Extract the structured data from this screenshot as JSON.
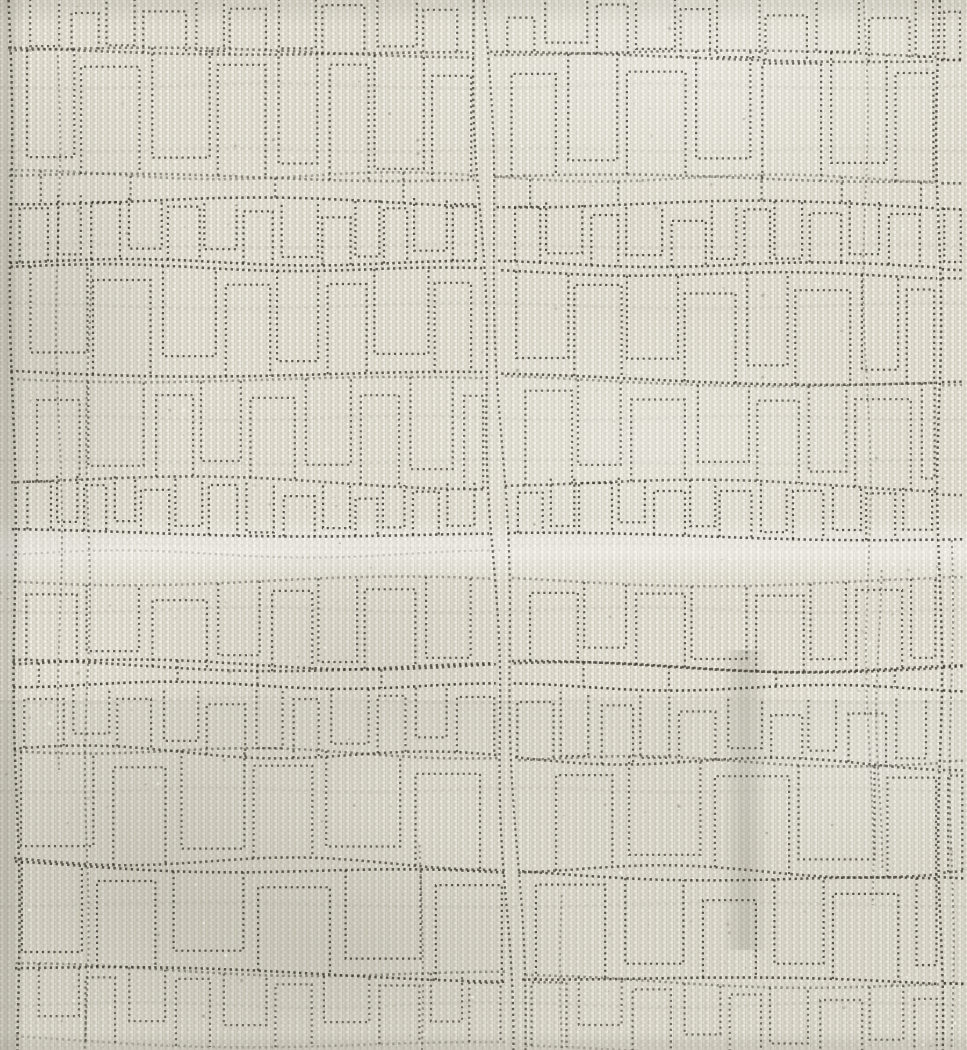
{
  "scene": {
    "description": "Close-up photograph of handwoven off-white linen fabric embroidered with dark running-stitch thread forming horizontal bands of interlocking rectangular meander (battlement) motifs, crossed by vertical stitched seam lines and soft fold shadows",
    "type": "fabric-textile-photo"
  },
  "canvas": {
    "width": 967,
    "height": 1050
  },
  "seed": 13,
  "palette": {
    "fabric_base": "#e6e3d8",
    "weave_gap": "#ddd9cc",
    "weave_light": "#f2f0e8",
    "weave_mid": "#dad6c9",
    "weave_light2": "#ece9df",
    "weave_mid2": "#d2cec0",
    "warp": "#b7b3a5",
    "weft_ghost": "#a29e90",
    "stitch": "#3a362d",
    "stitch_soft": "#716c5c"
  },
  "weave": {
    "cell_w": 7.2,
    "cell_h": 6.4,
    "thread_w": 3.3,
    "thread_h": 2.5
  },
  "stitch_style": {
    "dash": "2.4 3.4",
    "teeth_dash": "2.2 3.6",
    "width": 2.2,
    "boundary_width": 2.55
  },
  "segments": [
    [
      [
        8,
        16
      ],
      [
        470,
        510
      ]
    ],
    [
      [
        490,
        527
      ],
      [
        936,
        940
      ]
    ],
    [
      [
        941,
        944
      ],
      [
        963,
        966
      ]
    ]
  ],
  "bands": [
    {
      "type": "comb",
      "y1": -40,
      "y2": 48,
      "tooth": 34,
      "gap": 9,
      "insetT": 45,
      "insetB": 6,
      "op": 0.72,
      "noTop": true,
      "botOp": 0.9
    },
    {
      "type": "comb",
      "y1": 48,
      "y2": 174,
      "tooth": 48,
      "gap": 9,
      "insetT": 15,
      "insetB": 14,
      "op": 0.75,
      "topOp": 0.75,
      "botOp": 0.7
    },
    {
      "type": "rails",
      "y1": 174,
      "y2": 200,
      "tick": 105,
      "op": 0.8,
      "topOp": 0.5
    },
    {
      "type": "comb",
      "y1": 200,
      "y2": 262,
      "tooth": 29,
      "gap": 7,
      "insetT": 10,
      "insetB": 9,
      "op": 0.8,
      "noTop": true
    },
    {
      "type": "comb",
      "y1": 266,
      "y2": 371,
      "tooth": 46,
      "gap": 9,
      "insetT": 15,
      "insetB": 16,
      "op": 0.78
    },
    {
      "type": "comb",
      "y1": 375,
      "y2": 477,
      "tooth": 44,
      "gap": 9,
      "insetT": 17,
      "insetB": 14,
      "op": 0.7,
      "topOp": 0.6
    },
    {
      "type": "comb",
      "y1": 479,
      "y2": 531,
      "tooth": 26,
      "gap": 7,
      "insetT": 9,
      "insetB": 8,
      "op": 0.8,
      "noTop": true
    },
    {
      "type": "line",
      "y": 554,
      "x1": 6,
      "x2": 500,
      "op": 0.3
    },
    {
      "type": "comb",
      "y1": 578,
      "y2": 663,
      "tooth": 44,
      "gap": 9,
      "insetT": 13,
      "insetB": 12,
      "op": 0.75,
      "topOp": 0.55
    },
    {
      "type": "rails",
      "y1": 663,
      "y2": 684,
      "tick": 110,
      "op": 0.85,
      "topOp": 0.9
    },
    {
      "type": "comb",
      "y1": 684,
      "y2": 748,
      "tooth": 32,
      "gap": 9,
      "insetT": 11,
      "insetB": 10,
      "op": 0.72,
      "noTop": true
    },
    {
      "type": "comb",
      "y1": 750,
      "y2": 860,
      "tooth": 60,
      "gap": 14,
      "insetT": 16,
      "insetB": 15,
      "op": 0.72,
      "topOp": 0.7,
      "slopeExtra": 6
    },
    {
      "type": "comb",
      "y1": 862,
      "y2": 966,
      "tooth": 63,
      "gap": 14,
      "insetT": 16,
      "insetB": 15,
      "op": 0.8,
      "slopeExtra": 8,
      "botOp": 1
    },
    {
      "type": "comb",
      "y1": 968,
      "y2": 1040,
      "tooth": 36,
      "gap": 10,
      "insetT": 10,
      "insetB": 20,
      "op": 0.65,
      "topOp": 0.7,
      "botOp": 0.4,
      "slopeExtra": 8
    }
  ],
  "verticals": [
    {
      "x1": 9,
      "x2": 19,
      "y1": 0,
      "y2": 1050,
      "op": 0.8,
      "sw": 2.5
    },
    {
      "x1": 57,
      "x2": 62,
      "y1": 55,
      "y2": 770,
      "op": 0.45,
      "sw": 2.1
    },
    {
      "x1": 90,
      "x2": 86,
      "y1": 252,
      "y2": 1050,
      "op": 0.5,
      "sw": 2.1
    },
    {
      "x1": 472,
      "x2": 512,
      "y1": 0,
      "y2": 1050,
      "op": 0.75,
      "sw": 2.3
    },
    {
      "x1": 485,
      "x2": 525,
      "y1": 0,
      "y2": 1050,
      "op": 0.7,
      "sw": 2.2
    },
    {
      "x1": 864,
      "x2": 872,
      "y1": 0,
      "y2": 905,
      "op": 0.4,
      "sw": 2
    },
    {
      "x1": 877,
      "x2": 880,
      "y1": 570,
      "y2": 870,
      "op": 0.45,
      "sw": 2
    },
    {
      "x1": 938,
      "x2": 941,
      "y1": 0,
      "y2": 1050,
      "op": 0.8,
      "sw": 2.5
    },
    {
      "x1": 950,
      "x2": 952,
      "y1": 540,
      "y2": 1050,
      "op": 0.5,
      "sw": 2
    },
    {
      "x1": 418,
      "x2": 421,
      "y1": 845,
      "y2": 1050,
      "op": 0.45,
      "sw": 2
    },
    {
      "x1": 560,
      "x2": 562,
      "y1": 895,
      "y2": 1050,
      "op": 0.4,
      "sw": 2
    }
  ],
  "weft_rows": [
    86,
    150,
    246,
    306,
    418,
    462,
    546,
    610,
    700,
    790,
    905,
    1005
  ],
  "shading": [
    {
      "kind": "band",
      "axis": "y",
      "x": 0,
      "y": -20,
      "w": 967,
      "h": 45,
      "color": "#6f6c5f",
      "op": 0.12
    },
    {
      "kind": "flat",
      "x": 0,
      "y": 700,
      "w": 967,
      "h": 350,
      "color": "#8e8b7d",
      "op": 0.07
    },
    {
      "kind": "band",
      "axis": "y",
      "x": 0,
      "y": 518,
      "w": 967,
      "h": 64,
      "color": "#ffffff",
      "op": 0.38
    },
    {
      "kind": "radial",
      "cx": 690,
      "cy": 70,
      "rx": 330,
      "ry": 150,
      "color": "#ffffff",
      "op": 0.28
    },
    {
      "kind": "radial",
      "cx": 640,
      "cy": 440,
      "rx": 260,
      "ry": 130,
      "color": "#ffffff",
      "op": 0.2
    },
    {
      "kind": "radial",
      "cx": 40,
      "cy": 330,
      "rx": 150,
      "ry": 280,
      "color": "#7d7a6c",
      "op": 0.16
    },
    {
      "kind": "radial",
      "cx": 150,
      "cy": 880,
      "rx": 280,
      "ry": 220,
      "color": "#75725f",
      "op": 0.16
    },
    {
      "kind": "radial",
      "cx": 350,
      "cy": 660,
      "rx": 230,
      "ry": 130,
      "color": "#86836f",
      "op": 0.12
    },
    {
      "kind": "radial",
      "cx": 360,
      "cy": 960,
      "rx": 240,
      "ry": 140,
      "color": "#7b7868",
      "op": 0.14
    },
    {
      "kind": "band",
      "axis": "x",
      "x": 722,
      "y": 650,
      "w": 46,
      "h": 300,
      "color": "#6b685c",
      "op": 0.2
    },
    {
      "kind": "band",
      "axis": "x",
      "x": -14,
      "y": 0,
      "w": 40,
      "h": 1050,
      "color": "#6b685c",
      "op": 0.2
    },
    {
      "kind": "radial",
      "cx": 870,
      "cy": 760,
      "rx": 200,
      "ry": 120,
      "color": "#ffffff",
      "op": 0.18
    },
    {
      "kind": "band",
      "axis": "y",
      "x": 0,
      "y": 1032,
      "w": 967,
      "h": 28,
      "color": "#6f6c5f",
      "op": 0.12
    }
  ],
  "specks": {
    "count": 320,
    "colors": [
      {
        "c": "#565243",
        "o": 0.3
      },
      {
        "c": "#a7a396",
        "o": 0.4
      },
      {
        "c": "#fcfbf6",
        "o": 0.55
      },
      {
        "c": "#6e6857",
        "o": 0.3
      }
    ]
  }
}
